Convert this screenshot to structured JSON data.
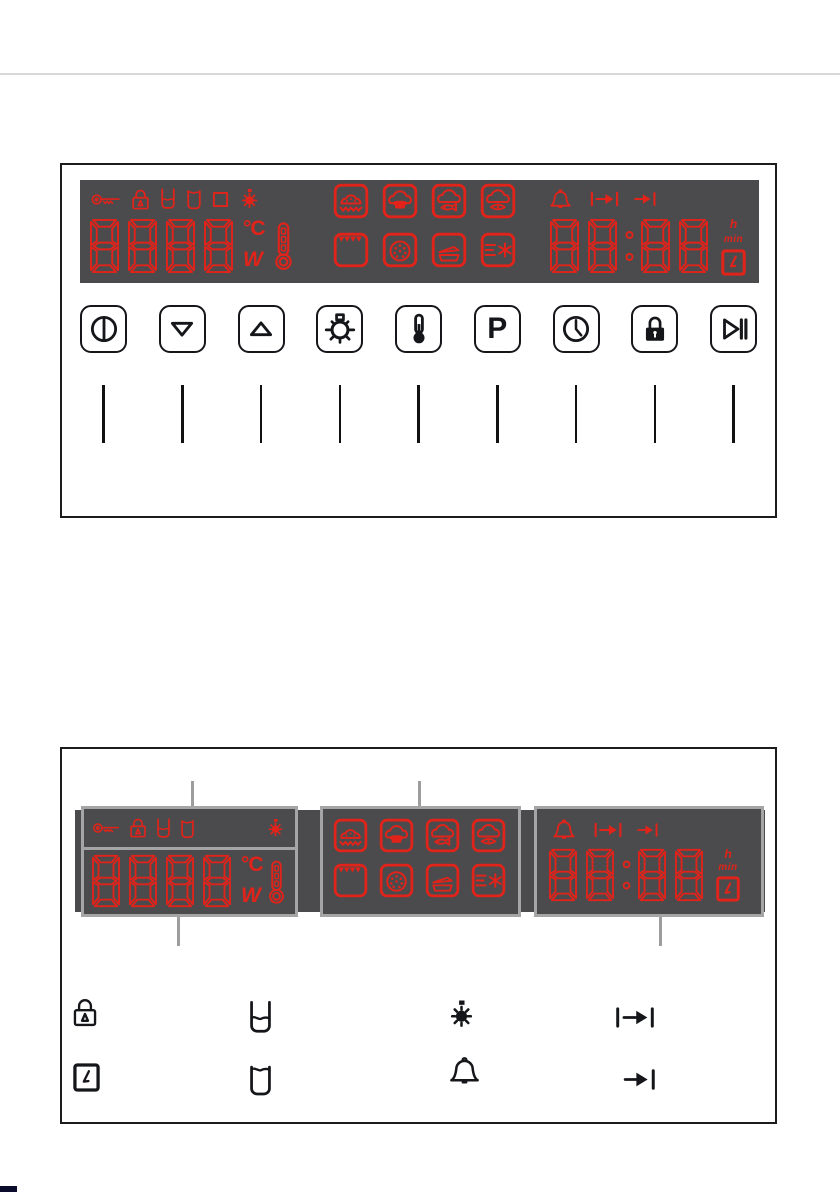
{
  "page": {
    "kind": "oven control panel manual illustration",
    "background": "#ffffff"
  },
  "colors": {
    "led_red": "#e2231a",
    "panel_background": "#4b4b4d",
    "figure_border": "#1c1c1e",
    "callout_gray": "#9d9d9d",
    "top_rule_gray": "#d8d8d8",
    "button_black": "#15161a",
    "corner_mark": "#0b0b2b"
  },
  "units": {
    "celsius": "°C",
    "watt": "W",
    "hour": "h",
    "minute": "min"
  },
  "display_test": {
    "temperature_digits": "8888",
    "time_digits": "88:88",
    "status_icons_left": [
      "key",
      "door-lock",
      "container-half",
      "container-full",
      "square",
      "oven-light"
    ],
    "status_icons_right": [
      "minute-minder-bell",
      "duration",
      "end-time"
    ],
    "extra_symbols": [
      "thermometer",
      "cooking-time-clock"
    ],
    "mode_icons": [
      "gentle-bake",
      "top-bottom-heat",
      "fan-top-heat",
      "fan-bottom-heat",
      "grill",
      "pizza-fan",
      "casserole",
      "defrost"
    ]
  },
  "control_buttons": [
    {
      "name": "on-off",
      "glyph": "power-circle",
      "label": ""
    },
    {
      "name": "decrease",
      "glyph": "triangle-down",
      "label": ""
    },
    {
      "name": "increase",
      "glyph": "triangle-up",
      "label": ""
    },
    {
      "name": "oven-light",
      "glyph": "lamp-burst",
      "label": ""
    },
    {
      "name": "temperature",
      "glyph": "thermometer",
      "label": ""
    },
    {
      "name": "program",
      "glyph": "letter",
      "label": "P"
    },
    {
      "name": "clock-functions",
      "glyph": "clock-face",
      "label": ""
    },
    {
      "name": "child-lock",
      "glyph": "padlock-solid",
      "label": ""
    },
    {
      "name": "start-pause",
      "glyph": "play-pause",
      "label": ""
    }
  ],
  "display_zones": {
    "left": "temperature / power display with status icons",
    "middle": "heating mode icons",
    "right": "time display with clock-function icons"
  },
  "legend_icons": {
    "row1": [
      "door-lock",
      "container-half",
      "oven-light",
      "duration"
    ],
    "row2": [
      "cooking-time-clock",
      "container-full",
      "minute-minder-bell",
      "end-time"
    ]
  }
}
